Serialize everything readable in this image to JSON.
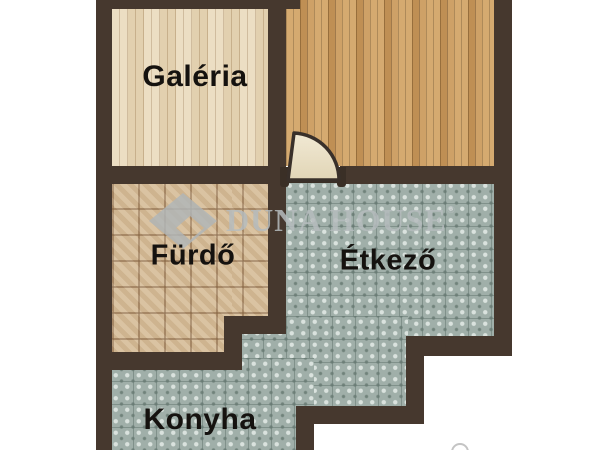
{
  "page": {
    "type": "apartment-floor-plan",
    "background": "#ffffff"
  },
  "rooms": [
    {
      "id": "galeria",
      "label": "Galéria",
      "floor": "light-wood-planks",
      "floor_color": "#e9d9bb"
    },
    {
      "id": "upper-right-room",
      "label": "",
      "floor": "medium-wood-planks",
      "floor_color": "#cb9b5e"
    },
    {
      "id": "furdo",
      "label": "Fürdő",
      "floor": "beige-mosaic-tile",
      "floor_color": "#d6bd99"
    },
    {
      "id": "etkezo",
      "label": "Étkező",
      "floor": "teal-pattern-tile",
      "floor_color": "#a0afa9"
    },
    {
      "id": "konyha",
      "label": "Konyha",
      "floor": "teal-pattern-tile",
      "floor_color": "#a0afa9"
    }
  ],
  "watermark": {
    "logo": "duna-house-diamond-logo",
    "text": "DUNA HOUSE",
    "registered_mark": "®",
    "color": "#b6bcbe"
  },
  "door": {
    "type": "quarter-circle-door-swing",
    "leaf_color": "#ece2cb"
  },
  "colors": {
    "wall": "#46382e",
    "label_text": "#15120f",
    "background": "#ffffff"
  }
}
